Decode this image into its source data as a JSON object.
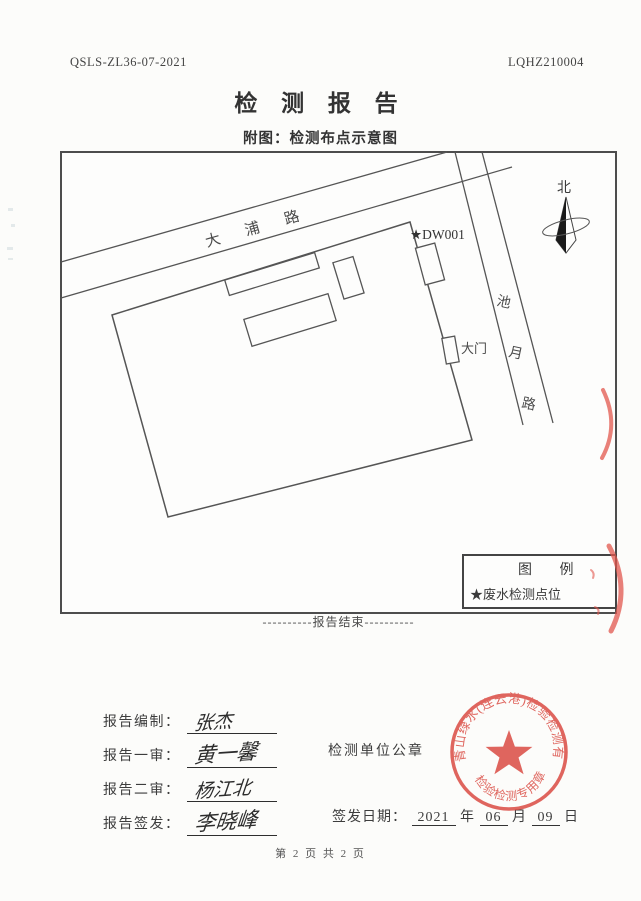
{
  "page": {
    "doc_code_left": "QSLS-ZL36-07-2021",
    "doc_code_right": "LQHZ210004",
    "title": "检 测 报 告",
    "subtitle": "附图：检测布点示意图",
    "end_of_report": "----------报告结束----------",
    "page_footer": "第 2 页 共 2 页"
  },
  "diagram": {
    "road_north": "大浦路",
    "road_east_chars": [
      "池",
      "月",
      "路"
    ],
    "point_label": "★DW001",
    "gate_label": "大门",
    "north_label": "北",
    "legend_title": "图 例",
    "legend_item": "★废水检测点位"
  },
  "signoff": {
    "rows": [
      {
        "label": "报告编制：",
        "signature": "张杰"
      },
      {
        "label": "报告一审：",
        "signature": "黄一馨"
      },
      {
        "label": "报告二审：",
        "signature": "杨江北"
      },
      {
        "label": "报告签发：",
        "signature": "李晓峰"
      }
    ],
    "seal_caption": "检测单位公章",
    "issue_date": {
      "label": "签发日期：",
      "year": "2021",
      "year_unit": "年",
      "month": "06",
      "month_unit": "月",
      "day": "09",
      "day_unit": "日"
    }
  },
  "seal": {
    "company": "青山绿水(连云港)检验检测有限公司",
    "type_label": "检验检测专用章",
    "color": "#d9453c"
  }
}
